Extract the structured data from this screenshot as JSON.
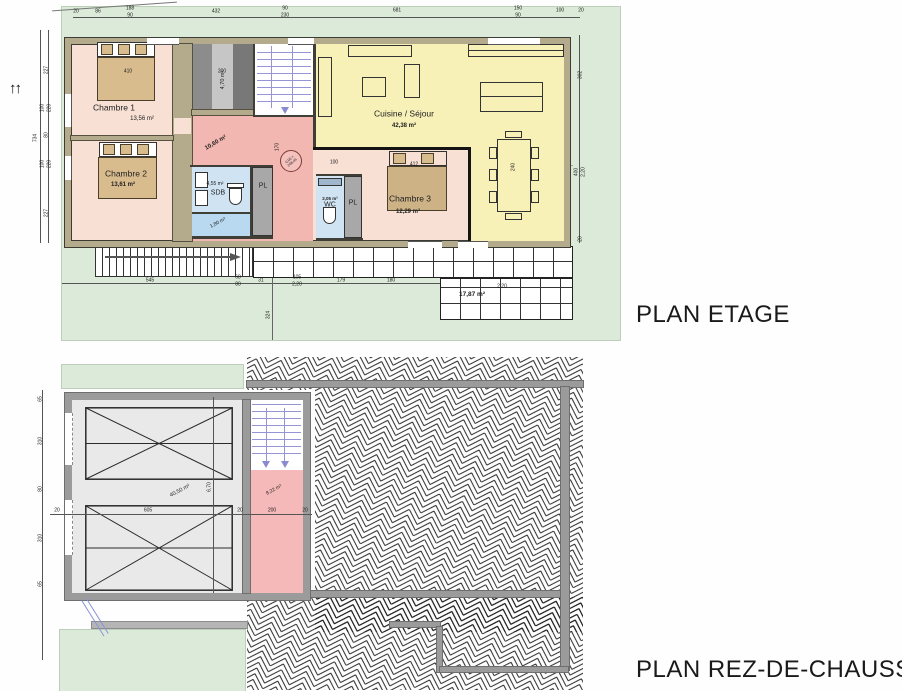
{
  "titles": {
    "etage": "PLAN ETAGE",
    "rdc": "PLAN REZ-DE-CHAUSSEE"
  },
  "colors": {
    "grass": "#dcead9",
    "wall_tan": "#b3ab8b",
    "wall_gray": "#9b9b9b",
    "bedroom_floor": "#f8e0d4",
    "hall_pink": "#f3b7b2",
    "bath_blue": "#cfe3f3",
    "kitchen_yellow": "#f7f1b8",
    "closet_gray": "#a8a8a8",
    "garage_gray": "#e9e9e9",
    "stair_blue": "#9595d6",
    "level_marker_red": "#7c3a36"
  },
  "etage": {
    "rooms": {
      "chambre1": {
        "name": "Chambre 1",
        "area": "13,56 m²"
      },
      "chambre2": {
        "name": "Chambre 2",
        "area": "13,61 m²"
      },
      "chambre3": {
        "name": "Chambre 3",
        "area": "12,29 m²"
      },
      "cuisine": {
        "name": "Cuisine / Séjour",
        "area": "42,38 m²"
      },
      "sdb": {
        "name": "SDB",
        "area": "4,55 m²"
      },
      "sdb_lower": {
        "area": "1,80 m²"
      },
      "wc": {
        "name": "WC",
        "area": "2,05 m²"
      },
      "pl1": {
        "name": "PL"
      },
      "pl2": {
        "name": "PL"
      },
      "closet": {
        "area": "4,70 m²"
      },
      "hall": {
        "area": "10,60 m²"
      },
      "terrace": {
        "area": "17,87 m²"
      }
    },
    "level_marker": {
      "line1": "0,00 =",
      "line2": "208,45"
    },
    "dims": [
      [
        "20",
        76,
        12,
        0
      ],
      [
        "86",
        98,
        12,
        0
      ],
      [
        "188",
        130,
        9,
        0
      ],
      [
        "90",
        130,
        16,
        0
      ],
      [
        "432",
        216,
        12,
        0
      ],
      [
        "90",
        285,
        9,
        0
      ],
      [
        "230",
        285,
        16,
        0
      ],
      [
        "681",
        397,
        11,
        0
      ],
      [
        "150",
        518,
        9,
        0
      ],
      [
        "90",
        518,
        16,
        0
      ],
      [
        "100",
        560,
        11,
        0
      ],
      [
        "20",
        581,
        11,
        0
      ],
      [
        "227",
        47,
        70,
        -90
      ],
      [
        "100",
        43,
        108,
        -90
      ],
      [
        "220",
        50,
        108,
        -90
      ],
      [
        "80",
        47,
        135,
        -90
      ],
      [
        "100",
        43,
        164,
        -90
      ],
      [
        "220",
        50,
        164,
        -90
      ],
      [
        "227",
        47,
        213,
        -90
      ],
      [
        "734",
        36,
        138,
        -90
      ],
      [
        "302",
        581,
        75,
        -90
      ],
      [
        "400",
        577,
        172,
        -90
      ],
      [
        "2,20",
        584,
        172,
        -90
      ],
      [
        "20",
        581,
        239,
        -90
      ],
      [
        "545",
        150,
        281,
        0
      ],
      [
        "68",
        238,
        278,
        0
      ],
      [
        "80",
        238,
        285,
        0
      ],
      [
        "31",
        261,
        281,
        0
      ],
      [
        "105",
        297,
        278,
        0
      ],
      [
        "2,20",
        297,
        285,
        0
      ],
      [
        "179",
        341,
        281,
        0
      ],
      [
        "180",
        391,
        281,
        0
      ],
      [
        "410",
        128,
        72,
        0
      ],
      [
        "200",
        222,
        72,
        0
      ],
      [
        "170",
        278,
        147,
        -90
      ],
      [
        "100",
        334,
        163,
        0
      ],
      [
        "412",
        414,
        165,
        0
      ],
      [
        "240",
        514,
        167,
        -90
      ],
      [
        "2,20",
        502,
        287,
        0
      ],
      [
        "324",
        269,
        315,
        -90
      ]
    ]
  },
  "rdc": {
    "garage_area": "40,50 m²",
    "stair_area": "8,22 m²",
    "dims": [
      [
        "65",
        41,
        399,
        -90
      ],
      [
        "310",
        41,
        441,
        -90
      ],
      [
        "80",
        41,
        489,
        -90
      ],
      [
        "310",
        41,
        538,
        -90
      ],
      [
        "65",
        41,
        584,
        -90
      ],
      [
        "20",
        57,
        511,
        0
      ],
      [
        "605",
        148,
        511,
        0
      ],
      [
        "20",
        240,
        511,
        0
      ],
      [
        "200",
        272,
        511,
        0
      ],
      [
        "20",
        305,
        511,
        0
      ],
      [
        "6,70",
        210,
        487,
        -90
      ]
    ]
  }
}
